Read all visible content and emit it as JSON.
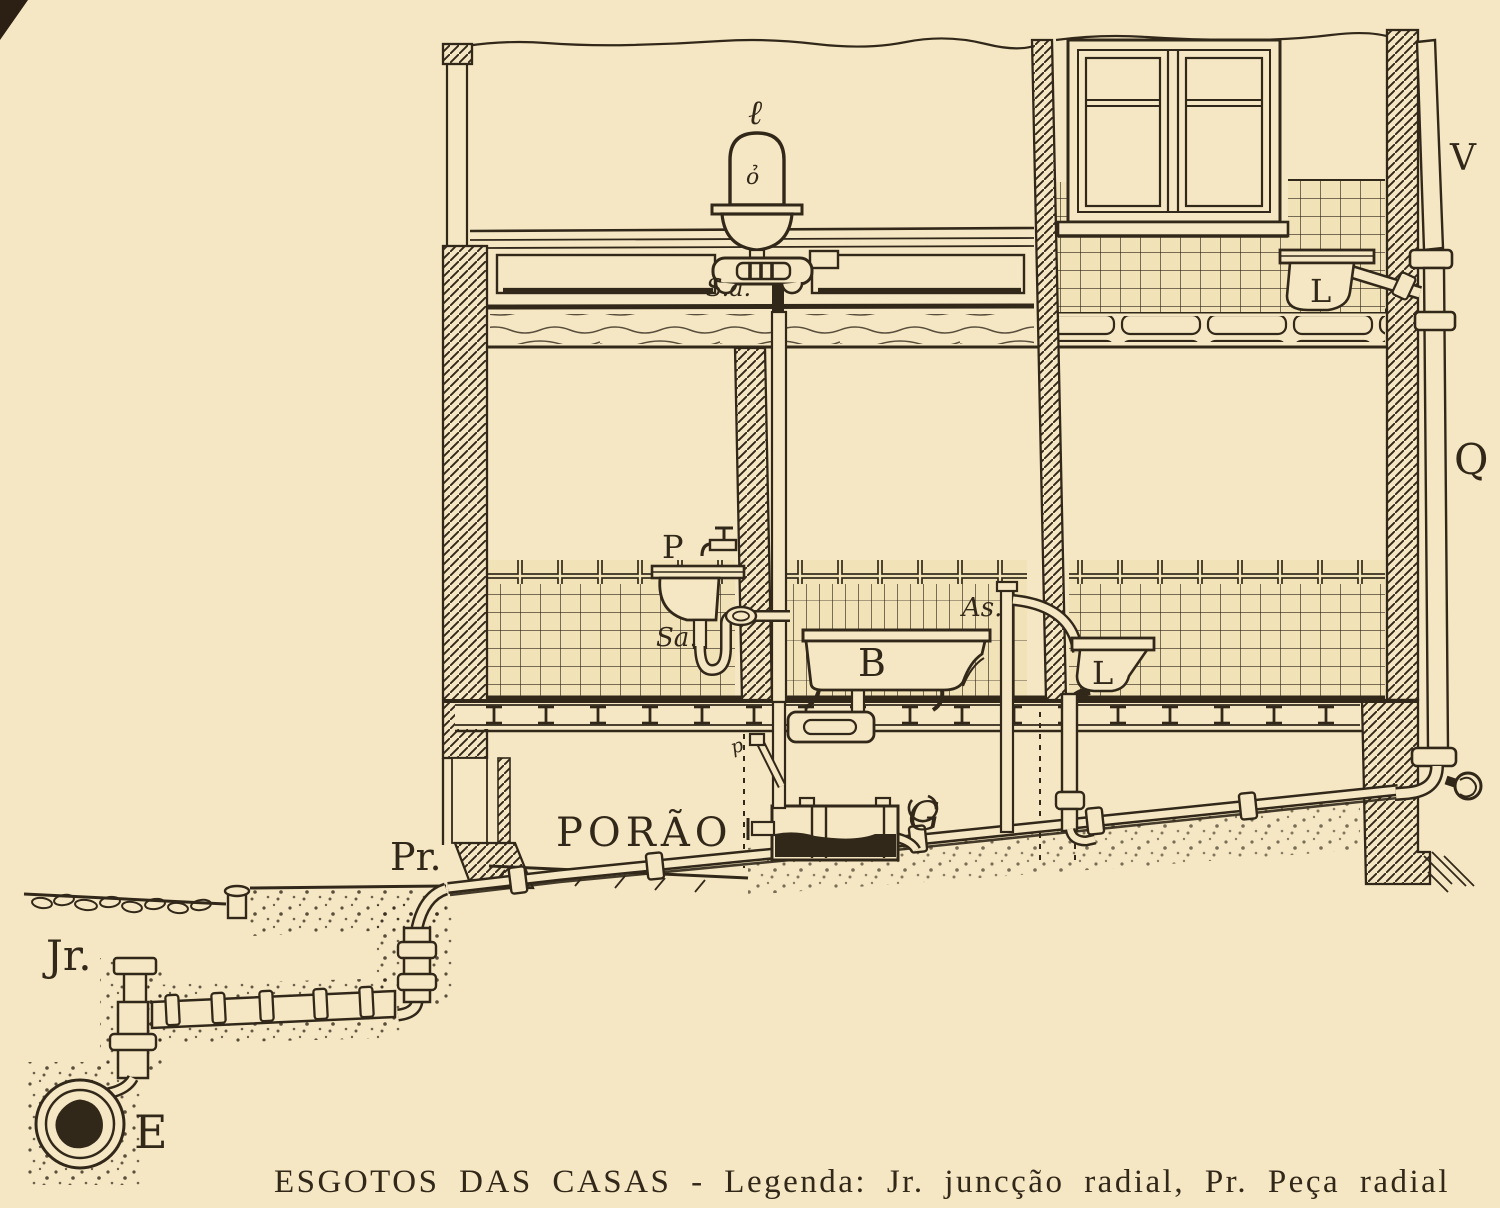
{
  "document": {
    "caption": "ESGOTOS DAS CASAS - Legenda: Jr. juncção radial, Pr. Peça radial",
    "title": "ESGOTOS DAS CASAS",
    "legend": [
      {
        "abbr": "Jr.",
        "meaning": "juncção radial"
      },
      {
        "abbr": "Pr.",
        "meaning": "Peça radial"
      }
    ]
  },
  "labels": {
    "roof_drain": "ℓ",
    "roof_drain_bowl": "ỏ",
    "upper_siphon": "S.a.",
    "vent_stack": "V",
    "soil_stack": "Q",
    "upper_water_closet": "L",
    "tap": "P",
    "basin_siphon": "Sa.",
    "ascending_pipe": "As.",
    "bathtub": "B",
    "lower_water_closet": "L",
    "grease_trap": "G",
    "basement": "PORÃO",
    "radial_piece": "Pr.",
    "radial_junction": "Jr.",
    "street_sewer": "E",
    "basement_branch": "p"
  },
  "colors": {
    "paper": "#f5e7c3",
    "ink": "#32281a"
  }
}
